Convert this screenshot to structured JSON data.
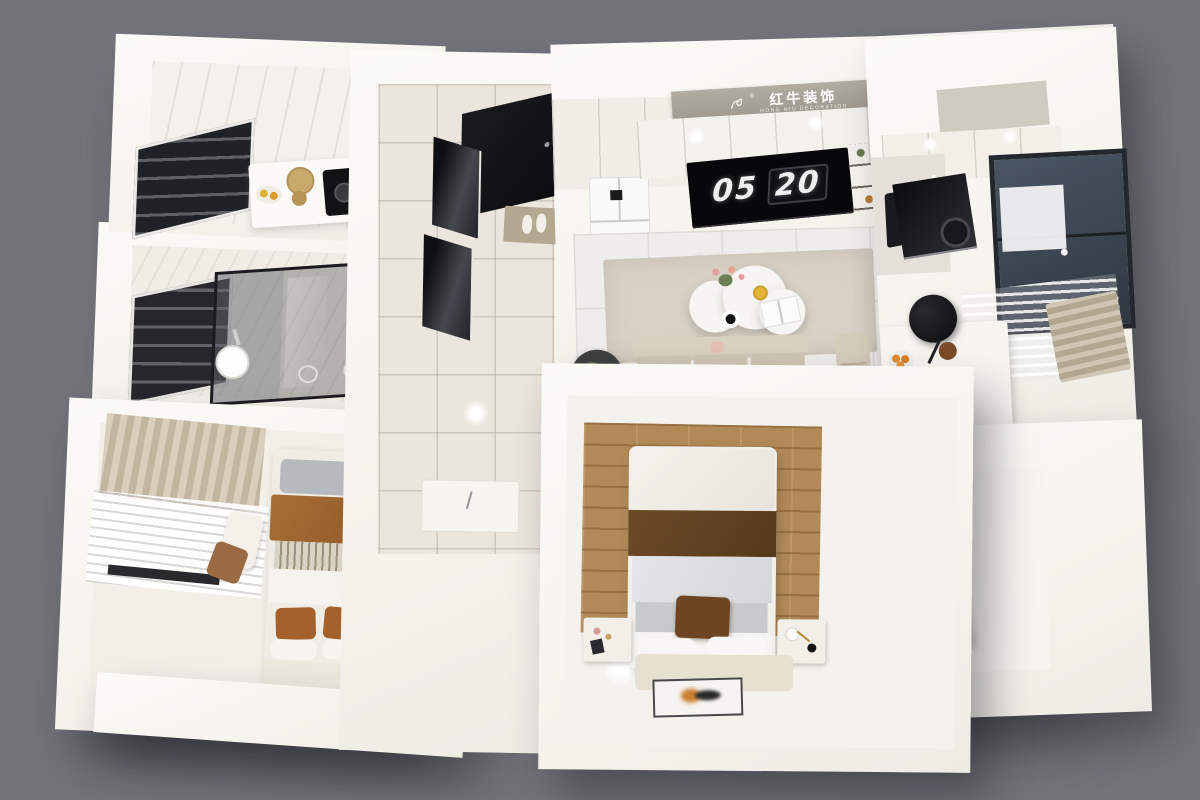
{
  "scene": {
    "type": "3d-apartment-floorplan-render",
    "background_color": "#73737a",
    "wall_color": "#f5f3ee"
  },
  "branding": {
    "logo_icon": "bull-icon",
    "registered_mark": "®",
    "logo_cn": "红牛装饰",
    "logo_en": "HONG NIU DECORATION",
    "banner_color": "#a8a399"
  },
  "clock": {
    "hours": "05",
    "minutes": "20",
    "screen_color": "#0a0a0c",
    "digit_color": "#efefef"
  },
  "rooms": [
    {
      "name": "kitchen",
      "position": "top-left"
    },
    {
      "name": "bathroom",
      "position": "middle-left"
    },
    {
      "name": "bedroom",
      "position": "bottom-left"
    },
    {
      "name": "entry-hallway",
      "position": "top-center"
    },
    {
      "name": "living-room",
      "position": "center"
    },
    {
      "name": "kitchen-dining-workspace",
      "position": "right"
    },
    {
      "name": "master-bedroom",
      "position": "bottom-center"
    },
    {
      "name": "bay-window",
      "position": "bottom-right"
    }
  ],
  "palette": {
    "wood_floor": "#b28a57",
    "rust_textile": "#a86f36",
    "dark_blanket": "#5f4122",
    "beige_textile": "#cfc5b2",
    "glass_dark": "#2b2e33",
    "appliance_black": "#131316"
  }
}
